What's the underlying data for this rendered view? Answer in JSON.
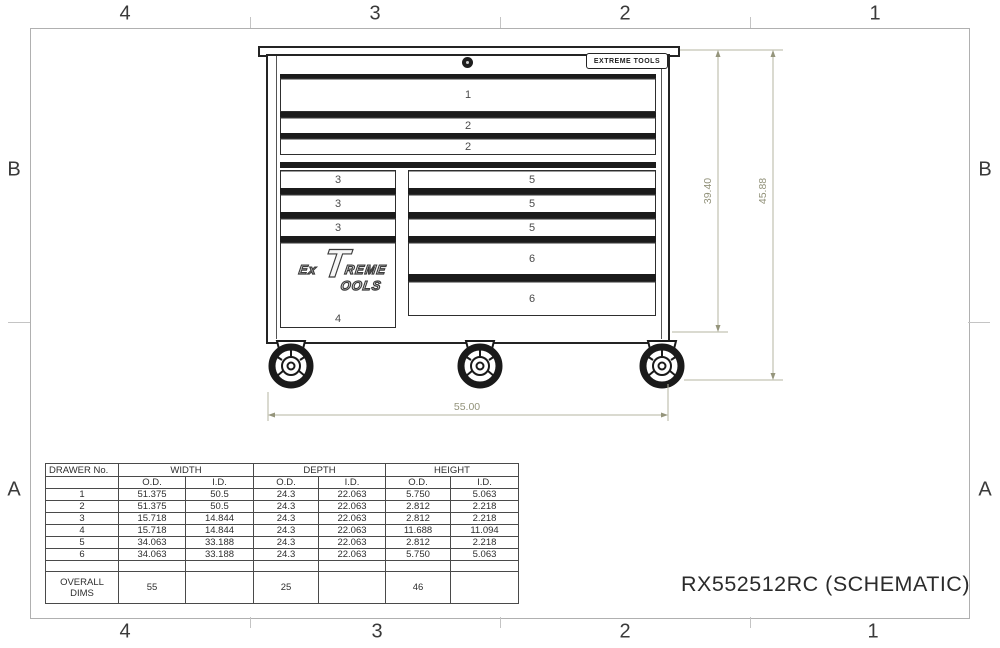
{
  "frame": {
    "zones_top": [
      "4",
      "3",
      "2",
      "1"
    ],
    "zones_bottom": [
      "4",
      "3",
      "2",
      "1"
    ],
    "zones_left": [
      "B",
      "A"
    ],
    "zones_right": [
      "B",
      "A"
    ]
  },
  "title": "RX552512RC (SCHEMATIC)",
  "cabinet": {
    "badge_text": "EXTREME TOOLS",
    "logo": {
      "prefix": "Ex",
      "big_letter": "T",
      "line1_rest": "REME",
      "line2": "OOLS"
    },
    "drawer_labels": {
      "d1": "1",
      "d2a": "2",
      "d2b": "2",
      "d3a": "3",
      "d3b": "3",
      "d3c": "3",
      "d4": "4",
      "d5a": "5",
      "d5b": "5",
      "d5c": "5",
      "d6a": "6",
      "d6b": "6"
    }
  },
  "dimensions": {
    "body_height": "39.40",
    "overall_height": "45.88",
    "overall_width": "55.00"
  },
  "table": {
    "col_groups": [
      "DRAWER No.",
      "WIDTH",
      "DEPTH",
      "HEIGHT"
    ],
    "sub_headers": [
      "",
      "O.D.",
      "I.D.",
      "O.D.",
      "I.D.",
      "O.D.",
      "I.D."
    ],
    "rows": [
      [
        "1",
        "51.375",
        "50.5",
        "24.3",
        "22.063",
        "5.750",
        "5.063"
      ],
      [
        "2",
        "51.375",
        "50.5",
        "24.3",
        "22.063",
        "2.812",
        "2.218"
      ],
      [
        "3",
        "15.718",
        "14.844",
        "24.3",
        "22.063",
        "2.812",
        "2.218"
      ],
      [
        "4",
        "15.718",
        "14.844",
        "24.3",
        "22.063",
        "11.688",
        "11.094"
      ],
      [
        "5",
        "34.063",
        "33.188",
        "24.3",
        "22.063",
        "2.812",
        "2.218"
      ],
      [
        "6",
        "34.063",
        "33.188",
        "24.3",
        "22.063",
        "5.750",
        "5.063"
      ]
    ],
    "overall_row": [
      "OVERALL\nDIMS",
      "55",
      "",
      "25",
      "",
      "46",
      ""
    ]
  }
}
